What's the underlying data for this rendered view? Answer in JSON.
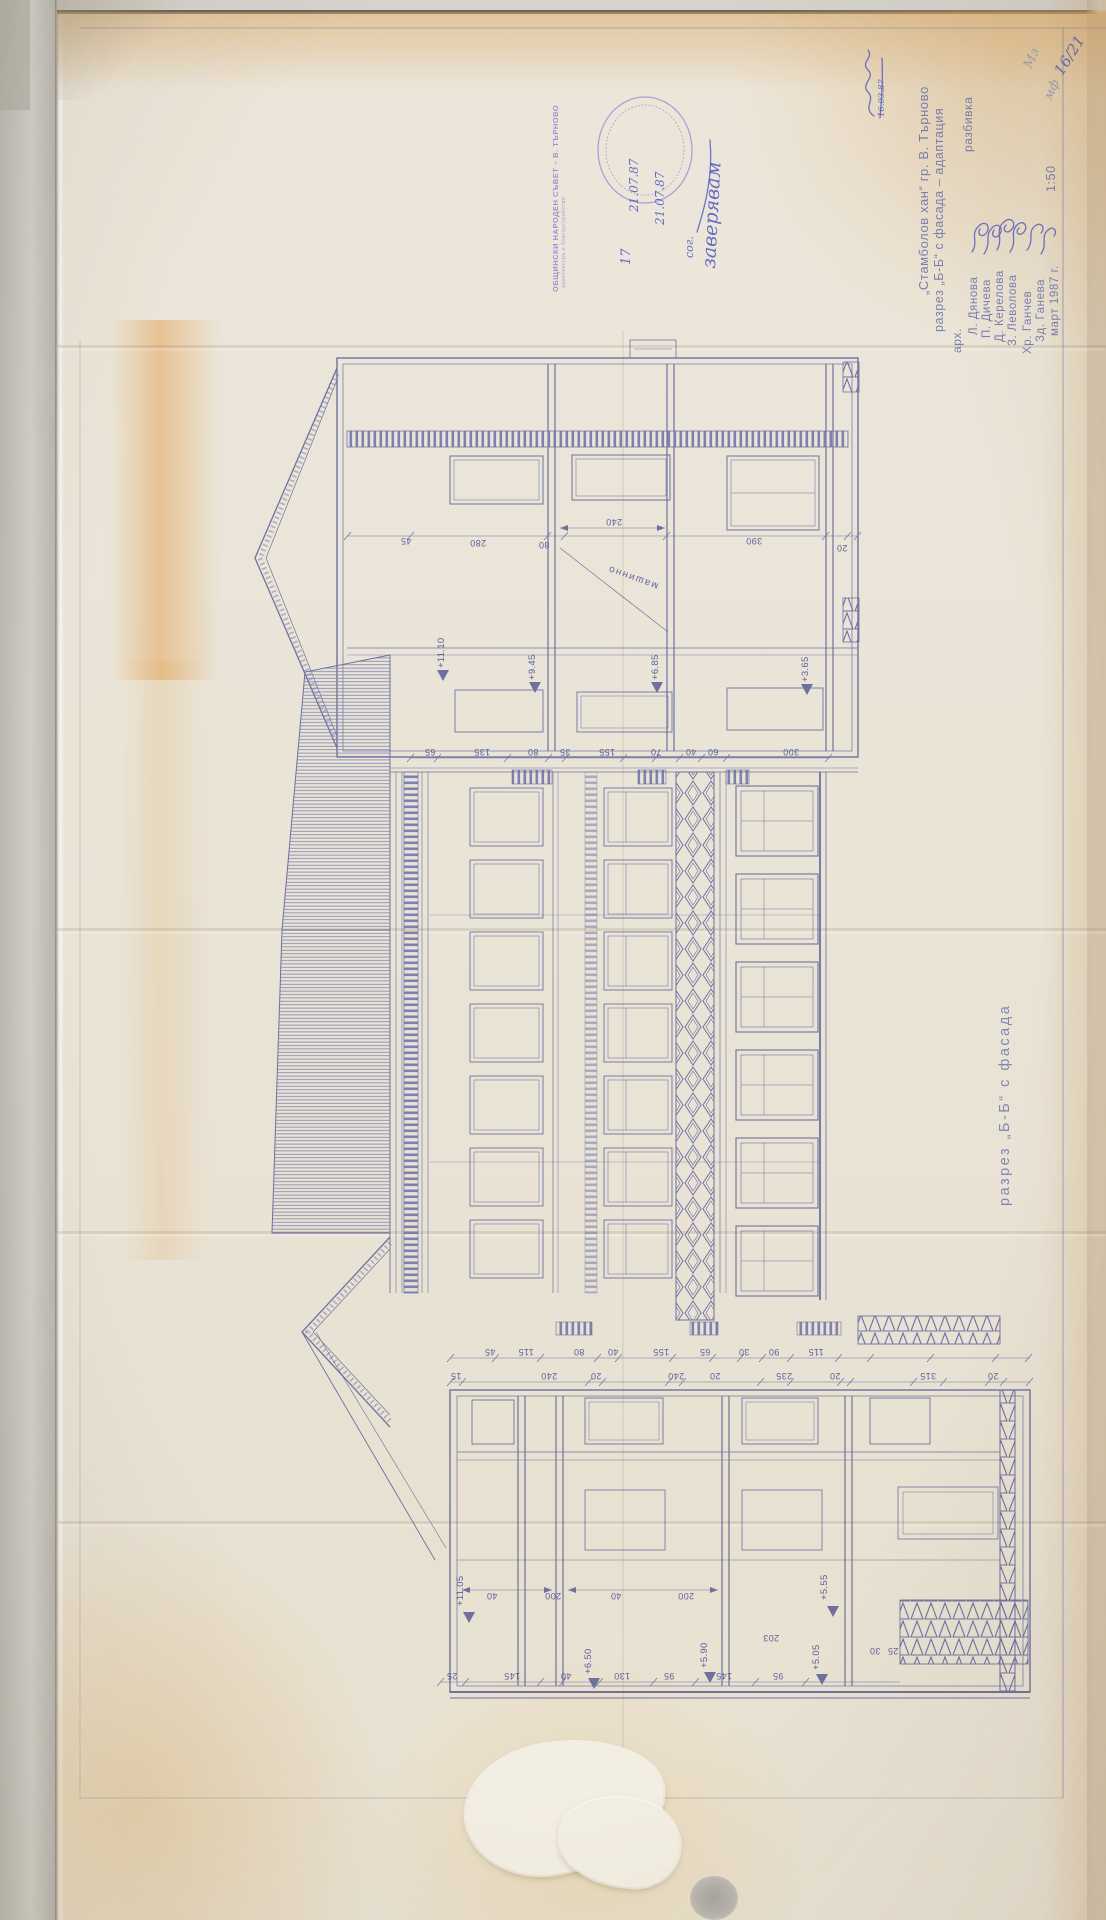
{
  "sheet": {
    "number": "16/21",
    "scale": "1:50",
    "date": "март 1987 г.",
    "object_title": "„Стамболов хан“ гр. В. Търново",
    "drawing_title": "разрез „Б-Б“ с фасада – адаптация",
    "phase": "разбивка",
    "team_label": "арх.",
    "architects": [
      "Л. Дянова",
      "П. Дичева",
      "Д. Керелова",
      "З. Леволова"
    ],
    "signed_also": [
      "Хр. Ганчев",
      "Зд. Ганева"
    ],
    "pencil_initials": [
      "Мз",
      "мф"
    ],
    "received_date": "16.03.87"
  },
  "stamp": {
    "org_line1": "ОБЩИНСКИ НАРОДЕН СЪВЕТ – В. ТЪРНОВО",
    "org_line2": "архитектура и благоустройство",
    "number": "17",
    "date1": "21.07.87",
    "date2": "21.07.87",
    "note_small": "сог.",
    "note_script": "заверявам"
  },
  "labels": {
    "section": "разрез „Б-Б“ с фасада",
    "room": "машинно"
  },
  "colors": {
    "ink": "#585d97",
    "paper": "#eae4d8",
    "stamp": "#9d7fd4"
  },
  "dims": {
    "t1": [
      "45",
      "280",
      "80",
      "240",
      "390",
      "20"
    ],
    "t2": [
      "65",
      "135",
      "80",
      "35",
      "155",
      "70",
      "40",
      "60",
      "300"
    ],
    "b1": [
      "45",
      "115",
      "80",
      "40",
      "155",
      "65",
      "30",
      "90",
      "115"
    ],
    "b2": [
      "15",
      "240",
      "20",
      "240",
      "20",
      "235",
      "20",
      "315",
      "20"
    ],
    "bi": [
      "40",
      "200",
      "40",
      "200"
    ],
    "bm": [
      "203",
      "30",
      "25"
    ],
    "b3": [
      "25",
      "145",
      "40",
      "130",
      "95",
      "145",
      "95"
    ]
  },
  "levels": {
    "top": [
      "+11.10",
      "+9.45",
      "+6.85",
      "+3.65"
    ],
    "bottom": [
      "+11.05",
      "+5.55",
      "+6.50",
      "+5.90",
      "+5.05"
    ]
  }
}
